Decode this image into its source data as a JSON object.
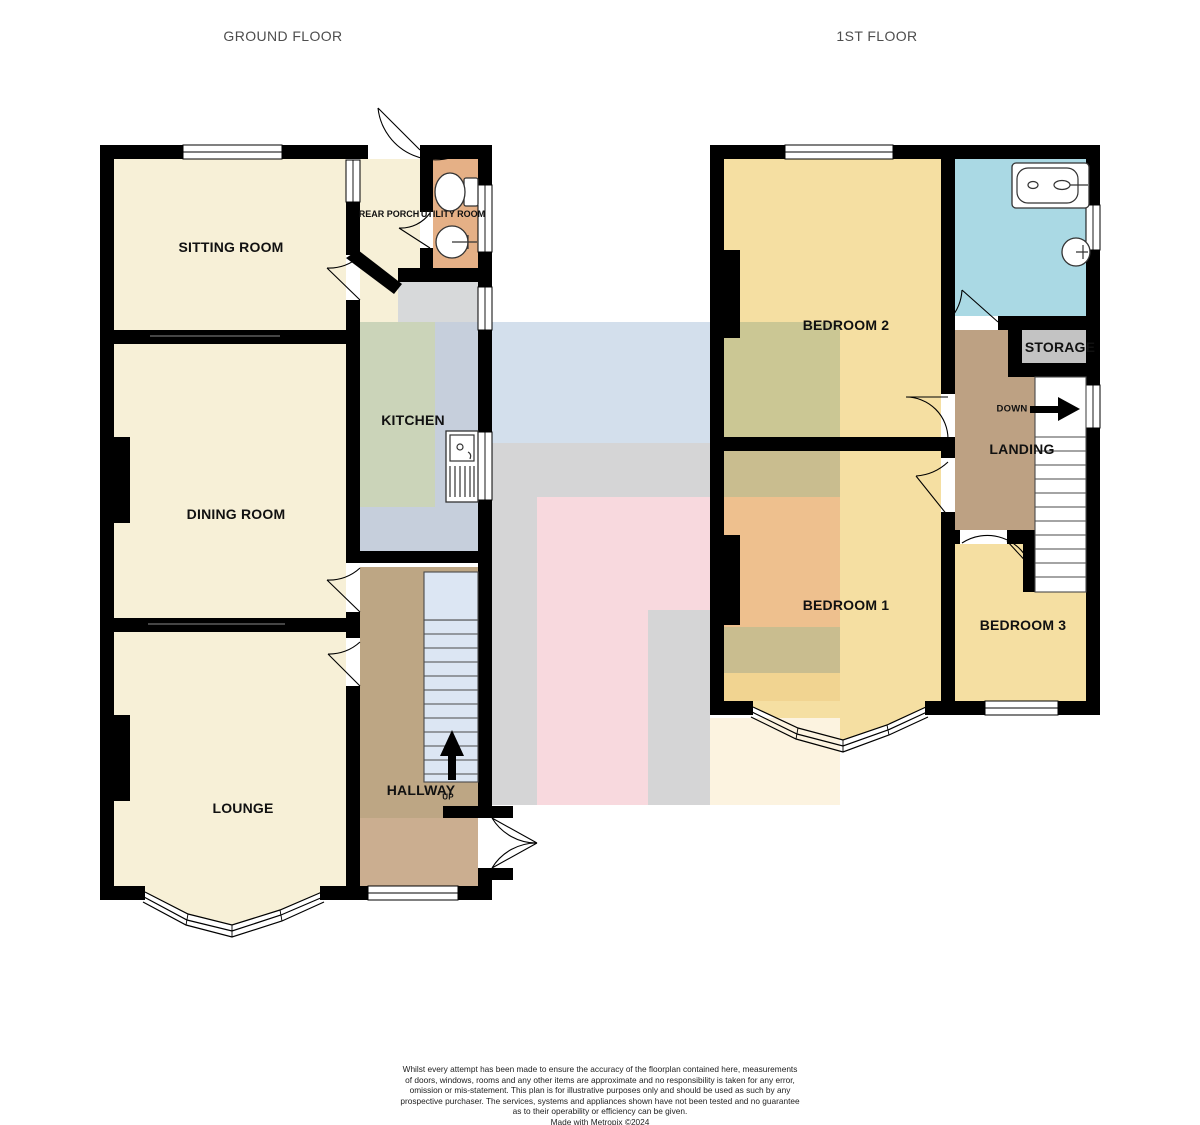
{
  "titles": {
    "ground_floor": "GROUND FLOOR",
    "first_floor": "1ST FLOOR"
  },
  "ground_floor": {
    "rooms": {
      "sitting_room": "SITTING ROOM",
      "dining_room": "DINING ROOM",
      "lounge": "LOUNGE",
      "kitchen": "KITCHEN",
      "hallway": "HALLWAY",
      "rear_porch": "REAR PORCH",
      "utility_room": "UTILITY ROOM"
    },
    "stairs_direction": "UP"
  },
  "first_floor": {
    "rooms": {
      "bedroom_1": "BEDROOM 1",
      "bedroom_2": "BEDROOM 2",
      "bedroom_3": "BEDROOM 3",
      "landing": "LANDING",
      "storage": "STORAGE"
    },
    "stairs_direction": "DOWN"
  },
  "disclaimer": {
    "lines": [
      "Whilst every attempt has been made to ensure the accuracy of the floorplan contained here, measurements",
      "of doors, windows, rooms and any other items are approximate and no responsibility is taken for any error,",
      "omission or mis-statement. This plan is for illustrative purposes only and should be used as such by any",
      "prospective purchaser. The services, systems and appliances shown have not been tested and no guarantee",
      "as to their operability or efficiency can be given.",
      "Made with Metropix ©2024"
    ]
  },
  "colors": {
    "wall": "#000000",
    "room_cream": "#f7f0d7",
    "room_yellow": "#f5dfa2",
    "bathroom_blue": "#aad9e4",
    "utility_orange": "#e5b086",
    "hallway_tan": "#bda684",
    "porch_tan": "#cbae90",
    "landing_brown": "#bda183",
    "kitchen_gray": "#c6cfdc",
    "storage_gray": "#c3c3c3",
    "stairs_blue": "#dce6f3",
    "overlay_blue": "#d3dfec",
    "overlay_gray": "#d5d5d6",
    "overlay_pink": "#f8d9de",
    "overlay_cream": "#fcf3e0",
    "overlay_green": "#cbd4b9",
    "overlay_corridor": "#d7d9da",
    "band_olive_dark": "#c9bd8f",
    "band_olive": "#cbc794",
    "band_orange": "#eec08e",
    "band_yellow": "#f1d491"
  }
}
